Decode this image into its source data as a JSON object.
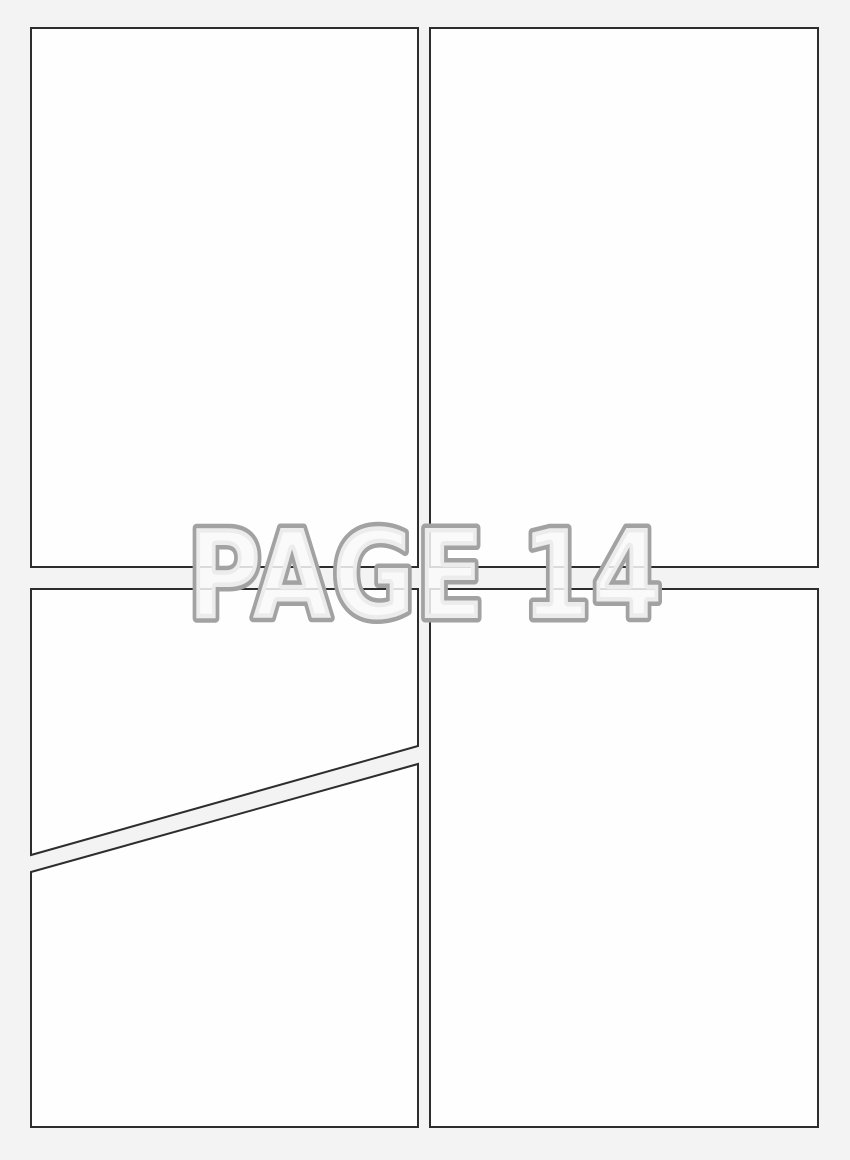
{
  "watermark": {
    "text": "PAGE 14",
    "font_size": 123,
    "center_x": 425,
    "baseline_y": 618,
    "text_length": 476,
    "outline_width": 9,
    "fill_opacity": 0.85
  },
  "colors": {
    "background": "#f3f3f4",
    "panel_fill": "#fefefe",
    "panel_border": "#2d2d2d",
    "watermark_outline": "#a2a2a2",
    "watermark_fill": "#f9f9f9"
  },
  "panel_border_width": 2,
  "panels": [
    {
      "name": "panel-top-left",
      "shape": "rect",
      "x": 31,
      "y": 28,
      "width": 387,
      "height": 539
    },
    {
      "name": "panel-top-right",
      "shape": "rect",
      "x": 430,
      "y": 28,
      "width": 388,
      "height": 539
    },
    {
      "name": "panel-middle-left",
      "shape": "polygon",
      "points": [
        [
          31,
          589
        ],
        [
          418,
          589
        ],
        [
          418,
          746
        ],
        [
          31,
          855
        ]
      ]
    },
    {
      "name": "panel-bottom-left",
      "shape": "polygon",
      "points": [
        [
          31,
          872
        ],
        [
          418,
          764
        ],
        [
          418,
          1127
        ],
        [
          31,
          1127
        ]
      ]
    },
    {
      "name": "panel-bottom-right",
      "shape": "rect",
      "x": 430,
      "y": 589,
      "width": 388,
      "height": 538
    }
  ]
}
